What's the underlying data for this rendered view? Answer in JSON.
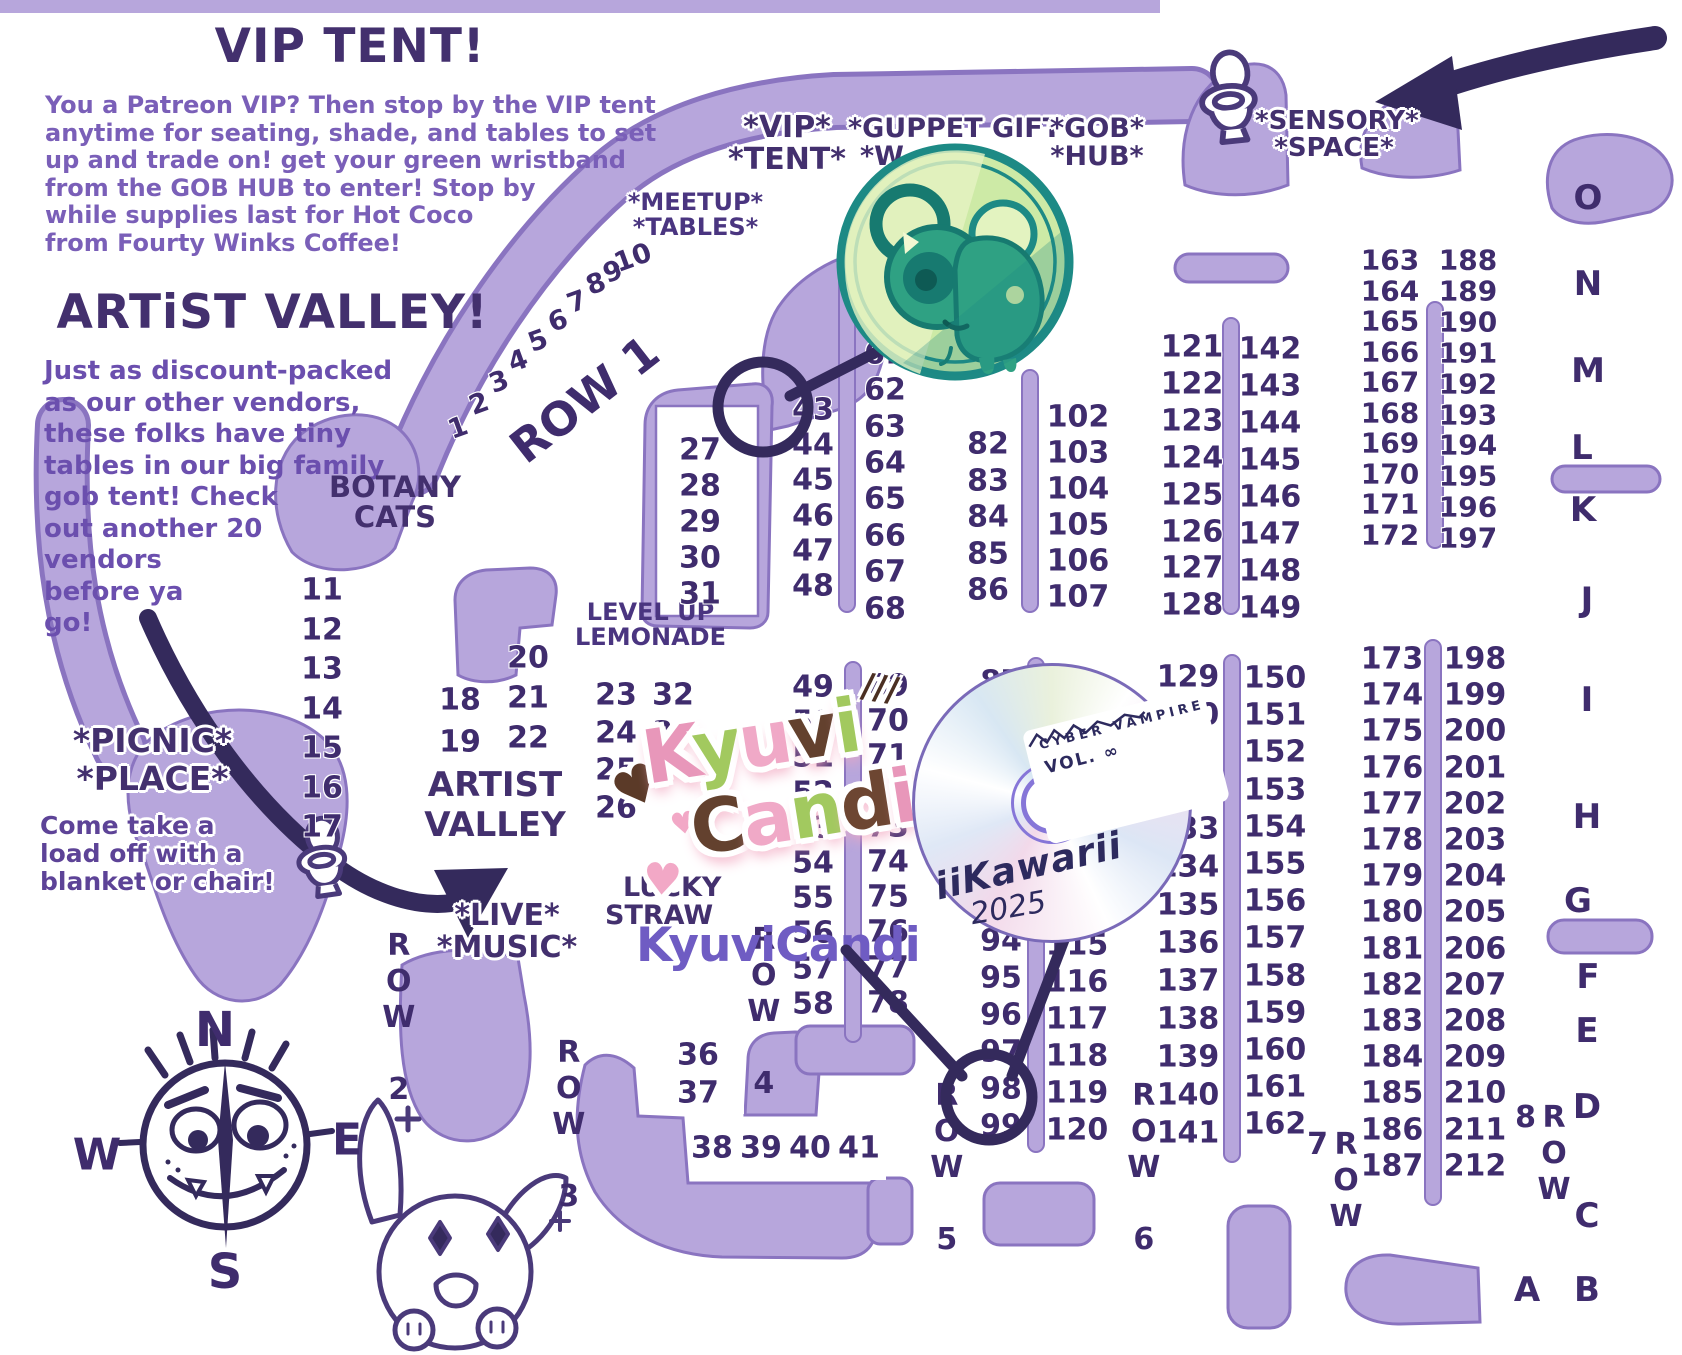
{
  "colors": {
    "road_fill": "#b7a6dc",
    "road_edge": "#8a74c0",
    "dark": "#3f2c6d",
    "heading": "#43306e",
    "paragraph": "#7a5fb8",
    "arrow": "#342a5c",
    "coin_teal": "#1d8a85",
    "coin_face": "#cdeaa6"
  },
  "vip": {
    "title": "VIP TENT!",
    "lines": [
      "You a Patreon VIP? Then stop by the VIP tent",
      "anytime for seating, shade, and tables to set",
      "up and trade on! get your green wristband",
      "from the GOB HUB to enter! Stop by",
      "while supplies last for Hot Coco",
      "from Fourty Winks Coffee!"
    ]
  },
  "artist_valley": {
    "title": "ARTiST VALLEY!",
    "lines": [
      "Just as discount-packed",
      "as our other vendors,",
      "these folks have tiny",
      "tables in our big family",
      "gob tent! Check",
      "out another 20",
      "vendors",
      "before ya",
      "go!"
    ]
  },
  "labels": {
    "vip_sign": [
      "*VIP*",
      "*TENT*"
    ],
    "guppet_gift": [
      "*GUPPET GIFT*",
      "*W"
    ],
    "gob_hub": [
      "*GOB*",
      "*HUB*"
    ],
    "sensory": [
      "*SENSORY*",
      "*SPACE*"
    ],
    "meetup": [
      "*MEETUP*",
      "*TABLES*"
    ],
    "botany": [
      "BOTANY",
      "CATS"
    ],
    "level_up": [
      "LEVEL UP",
      "LEMONADE"
    ],
    "artist_valley_sign": [
      "ARTIST",
      "VALLEY"
    ],
    "lucky": [
      "LUCKY",
      "STRAW"
    ],
    "live_music": [
      "*LIVE*",
      "*MUSIC*"
    ],
    "picnic_title": [
      "*PICNIC*",
      "*PLACE*"
    ],
    "picnic_lines": [
      "Come take a",
      "load off with a",
      "blanket or chair!"
    ]
  },
  "compass": {
    "points": [
      {
        "ch": "N",
        "x": 215,
        "y": 1030,
        "size": 48
      },
      {
        "ch": "W",
        "x": 97,
        "y": 1155,
        "size": 44
      },
      {
        "ch": "E",
        "x": 347,
        "y": 1140,
        "size": 44
      },
      {
        "ch": "S",
        "x": 225,
        "y": 1272,
        "size": 48
      }
    ]
  },
  "rows": [
    {
      "label": "ROW 1",
      "x": 585,
      "y": 400,
      "rot": -38,
      "size": 46
    },
    {
      "label": "ROW 2",
      "x": 398,
      "y": 1018,
      "vert": true
    },
    {
      "label": "ROW 3",
      "x": 568,
      "y": 1125,
      "vert": true
    },
    {
      "label": "ROW 4",
      "x": 763,
      "y": 1012,
      "vert": true
    },
    {
      "label": "ROW 5",
      "x": 946,
      "y": 1168,
      "vert": true
    },
    {
      "label": "ROW 6",
      "x": 1143,
      "y": 1168,
      "vert": true
    },
    {
      "label": "ROW 7",
      "x": 1331,
      "y": 1203,
      "vert": true
    },
    {
      "label": "ROW 8",
      "x": 1539,
      "y": 1185,
      "vert": true
    }
  ],
  "map": {
    "row1_diagonal": [
      {
        "v": "1",
        "x": 458,
        "y": 428
      },
      {
        "v": "2",
        "x": 479,
        "y": 404
      },
      {
        "v": "3",
        "x": 499,
        "y": 382
      },
      {
        "v": "4",
        "x": 518,
        "y": 361
      },
      {
        "v": "5",
        "x": 538,
        "y": 341
      },
      {
        "v": "6",
        "x": 558,
        "y": 321
      },
      {
        "v": "7",
        "x": 577,
        "y": 302
      },
      {
        "v": "8",
        "x": 596,
        "y": 284
      },
      {
        "v": "9",
        "x": 613,
        "y": 272
      },
      {
        "v": "10",
        "x": 633,
        "y": 258
      }
    ],
    "columns": [
      {
        "x": 700,
        "y0": 450,
        "step": 36,
        "values": [
          "27",
          "28",
          "29",
          "30",
          "31"
        ]
      },
      {
        "x": 322,
        "y0": 590,
        "step": 39.5,
        "values": [
          "11",
          "12",
          "13",
          "14",
          "15",
          "16",
          "17"
        ]
      },
      {
        "x": 460,
        "y0": 700,
        "step": 42,
        "values": [
          "18",
          "19"
        ]
      },
      {
        "x": 528,
        "y0": 658,
        "step": 40,
        "values": [
          "20",
          "21",
          "22"
        ]
      },
      {
        "x": 616,
        "y0": 695,
        "step": 37.5,
        "values": [
          "23",
          "24",
          "25",
          "26"
        ]
      },
      {
        "x": 673,
        "y0": 695,
        "step": 37.5,
        "values": [
          "32",
          "33",
          "34"
        ]
      },
      {
        "x": 698,
        "y0": 1055,
        "step": 38,
        "values": [
          "36",
          "37"
        ]
      },
      {
        "x": 813,
        "y0": 410,
        "step": 35.2,
        "values": [
          "43",
          "44",
          "45",
          "46",
          "47",
          "48"
        ]
      },
      {
        "x": 885,
        "y0": 281,
        "step": 36.4,
        "values": [
          "59",
          "60",
          "61",
          "62",
          "63",
          "64",
          "65",
          "66",
          "67",
          "68"
        ]
      },
      {
        "x": 988,
        "y0": 444,
        "step": 36.6,
        "values": [
          "82",
          "83",
          "84",
          "85",
          "86"
        ]
      },
      {
        "x": 1078,
        "y0": 417,
        "step": 36,
        "values": [
          "102",
          "103",
          "104",
          "105",
          "106",
          "107"
        ]
      },
      {
        "x": 813,
        "y0": 687,
        "step": 35.2,
        "values": [
          "49",
          "50",
          "51",
          "52",
          "53",
          "54",
          "55",
          "56",
          "57",
          "58"
        ]
      },
      {
        "x": 888,
        "y0": 686,
        "step": 35.2,
        "values": [
          "69",
          "70",
          "71",
          "72",
          "73",
          "74",
          "75",
          "76",
          "77",
          "78"
        ]
      },
      {
        "x": 1001,
        "y0": 682,
        "step": 37,
        "values": [
          "87",
          "88",
          "89",
          "90",
          "91",
          "92",
          "93",
          "94",
          "95",
          "96",
          "97",
          "98",
          "99"
        ]
      },
      {
        "x": 1077,
        "y0": 686,
        "step": 37,
        "values": [
          "108",
          "109",
          "110",
          "111",
          "112",
          "113",
          "114",
          "115",
          "116",
          "117",
          "118",
          "119",
          "120"
        ]
      },
      {
        "x": 1192,
        "y0": 347,
        "step": 36.9,
        "values": [
          "121",
          "122",
          "123",
          "124",
          "125",
          "126",
          "127",
          "128"
        ]
      },
      {
        "x": 1270,
        "y0": 349,
        "step": 37,
        "values": [
          "142",
          "143",
          "144",
          "145",
          "146",
          "147",
          "148",
          "149"
        ]
      },
      {
        "x": 1188,
        "y0": 677,
        "step": 38,
        "values": [
          "129",
          "130",
          "131",
          "132",
          "133",
          "134",
          "135",
          "136",
          "137",
          "138",
          "139",
          "140",
          "141"
        ]
      },
      {
        "x": 1275,
        "y0": 678,
        "step": 37.2,
        "values": [
          "150",
          "151",
          "152",
          "153",
          "154",
          "155",
          "156",
          "157",
          "158",
          "159",
          "160",
          "161",
          "162"
        ]
      },
      {
        "x": 1390,
        "y0": 260,
        "step": 30.5,
        "size": 28,
        "values": [
          "163",
          "164",
          "165",
          "166",
          "167",
          "168",
          "169",
          "170",
          "171",
          "172"
        ]
      },
      {
        "x": 1468,
        "y0": 260,
        "step": 30.9,
        "size": 28,
        "values": [
          "188",
          "189",
          "190",
          "191",
          "192",
          "193",
          "194",
          "195",
          "196",
          "197"
        ]
      },
      {
        "x": 1392,
        "y0": 659,
        "step": 36.2,
        "values": [
          "173",
          "174",
          "175",
          "176",
          "177",
          "178",
          "179",
          "180",
          "181",
          "182",
          "183",
          "184",
          "185",
          "186",
          "187"
        ]
      },
      {
        "x": 1475,
        "y0": 659,
        "step": 36.2,
        "values": [
          "198",
          "199",
          "200",
          "201",
          "202",
          "203",
          "204",
          "205",
          "206",
          "207",
          "208",
          "209",
          "210",
          "211",
          "212"
        ]
      }
    ],
    "horizontal_row": {
      "y": 1148,
      "x0": 712,
      "step": 49,
      "values": [
        "38",
        "39",
        "40",
        "41"
      ]
    },
    "letters": [
      {
        "ch": "O",
        "x": 1588,
        "y": 198
      },
      {
        "ch": "N",
        "x": 1588,
        "y": 284
      },
      {
        "ch": "M",
        "x": 1588,
        "y": 371
      },
      {
        "ch": "L",
        "x": 1582,
        "y": 448
      },
      {
        "ch": "K",
        "x": 1583,
        "y": 510
      },
      {
        "ch": "J",
        "x": 1587,
        "y": 600
      },
      {
        "ch": "I",
        "x": 1587,
        "y": 700
      },
      {
        "ch": "H",
        "x": 1587,
        "y": 817
      },
      {
        "ch": "G",
        "x": 1578,
        "y": 901
      },
      {
        "ch": "F",
        "x": 1588,
        "y": 977
      },
      {
        "ch": "E",
        "x": 1587,
        "y": 1031
      },
      {
        "ch": "D",
        "x": 1587,
        "y": 1107
      },
      {
        "ch": "C",
        "x": 1587,
        "y": 1216
      },
      {
        "ch": "B",
        "x": 1587,
        "y": 1290
      },
      {
        "ch": "A",
        "x": 1527,
        "y": 1290
      }
    ]
  },
  "stickers": {
    "kyuvi_logo": {
      "line1": "Kyuvi",
      "line2": "Candi",
      "hearts": [
        "♥",
        "♥",
        "♥"
      ],
      "dashes": "///"
    },
    "watermark": "KyuviCandi",
    "cd": {
      "label_title": "CYBER VAMPIRE",
      "label_vol": "VOL. ∞",
      "hand1": "iiKawarii",
      "hand2": "2025"
    },
    "highlighted_tables": [
      "43",
      "98"
    ]
  }
}
